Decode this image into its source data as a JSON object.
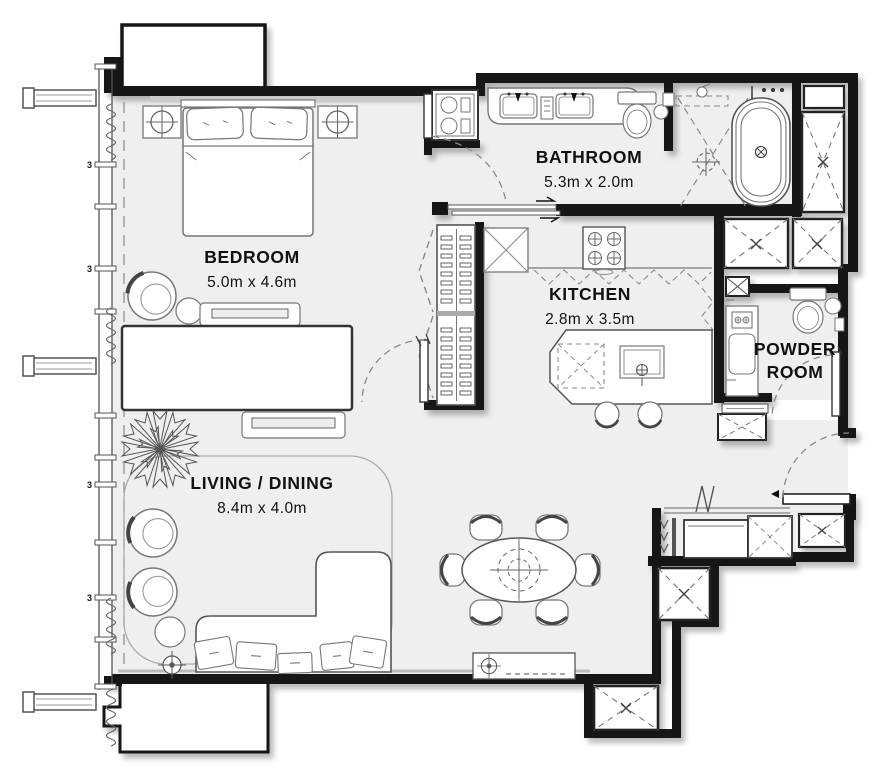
{
  "title": "Apartment floor plan",
  "rooms": {
    "bedroom": {
      "name": "BEDROOM",
      "dimensions": "5.0m x 4.6m"
    },
    "bathroom": {
      "name": "BATHROOM",
      "dimensions": "5.3m x 2.0m"
    },
    "kitchen": {
      "name": "KITCHEN",
      "dimensions": "2.8m x 3.5m"
    },
    "powder_room": {
      "name_line1": "POWDER",
      "name_line2": "ROOM"
    },
    "living_dining": {
      "name": "LIVING / DINING",
      "dimensions": "8.4m x 4.0m"
    }
  },
  "glazing_tick_label": "3",
  "colors": {
    "wall": "#161616",
    "floor": "#efefef",
    "furniture_line": "#777777",
    "dashed_line": "#8a8a8a",
    "background": "#ffffff"
  }
}
